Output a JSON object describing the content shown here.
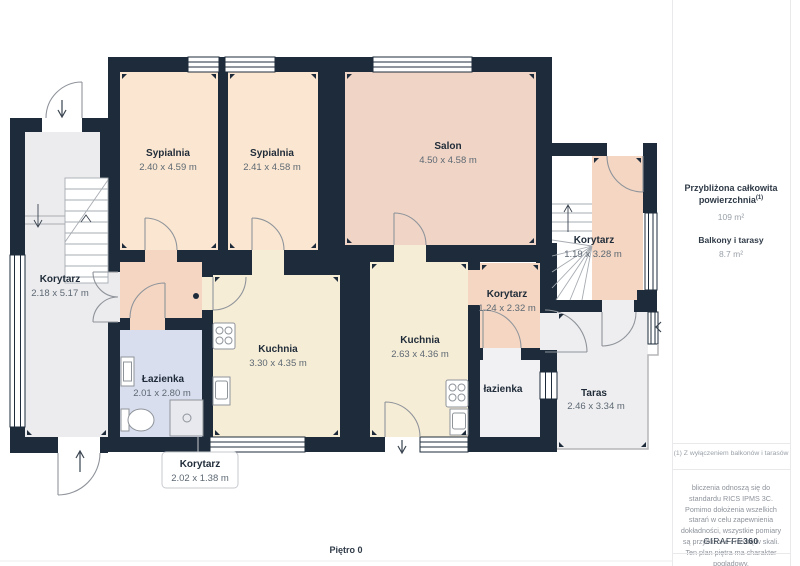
{
  "plan": {
    "floor_label": "Piętro 0",
    "rooms": {
      "sypialnia1": {
        "name": "Sypialnia",
        "dims": "2.40 x 4.59 m"
      },
      "sypialnia2": {
        "name": "Sypialnia",
        "dims": "2.41 x 4.58 m"
      },
      "salon": {
        "name": "Salon",
        "dims": "4.50 x 4.58 m"
      },
      "korytarz_left": {
        "name": "Korytarz",
        "dims": "2.18 x 5.17 m"
      },
      "korytarz_right": {
        "name": "Korytarz",
        "dims": "1.19 x 3.28 m"
      },
      "korytarz_mid": {
        "name": "Korytarz",
        "dims": "1.24 x 2.32 m"
      },
      "kuchnia1": {
        "name": "Kuchnia",
        "dims": "3.30 x 4.35 m"
      },
      "kuchnia2": {
        "name": "Kuchnia",
        "dims": "2.63 x 4.36 m"
      },
      "lazienka1": {
        "name": "Łazienka",
        "dims": "2.01 x 2.80 m"
      },
      "lazienka2": {
        "name": "łazienka",
        "dims": ""
      },
      "taras": {
        "name": "Taras",
        "dims": "2.46 x 3.34 m"
      },
      "korytarz_entry": {
        "name": "Korytarz",
        "dims": "2.02 x 1.38 m"
      }
    }
  },
  "sidebar": {
    "total_label_line1": "Przybliżona całkowita",
    "total_label_line2": "powierzchnia",
    "total_label_sup": "(1)",
    "total_value": "109 m²",
    "balcony_label": "Balkony i tarasy",
    "balcony_value": "8.7 m²",
    "footnote": "(1) Z wyłączeniem balkonów i tarasów",
    "disclaimer": "bliczenia odnoszą się do standardu RICS IPMS 3C. Pomimo dołożenia wszelkich starań w celu zapewnienia dokładności, wszystkie pomiary są przybliżone i nie są w skali. Ten plan piętra ma charakter poglądowy.",
    "logo_text": "GIRAFFE",
    "logo_bold": "360"
  },
  "colors": {
    "wall": "#1d2b3a",
    "bedroom_fill": "#fbe7d1",
    "salon_fill": "#f0d5c6",
    "corridor_fill": "#f4d6c2",
    "kitchen_fill": "#f6edd6",
    "bathroom_fill": "#d8deed",
    "neutral_fill": "#ececee",
    "terrace_fill": "#eeeef0"
  }
}
